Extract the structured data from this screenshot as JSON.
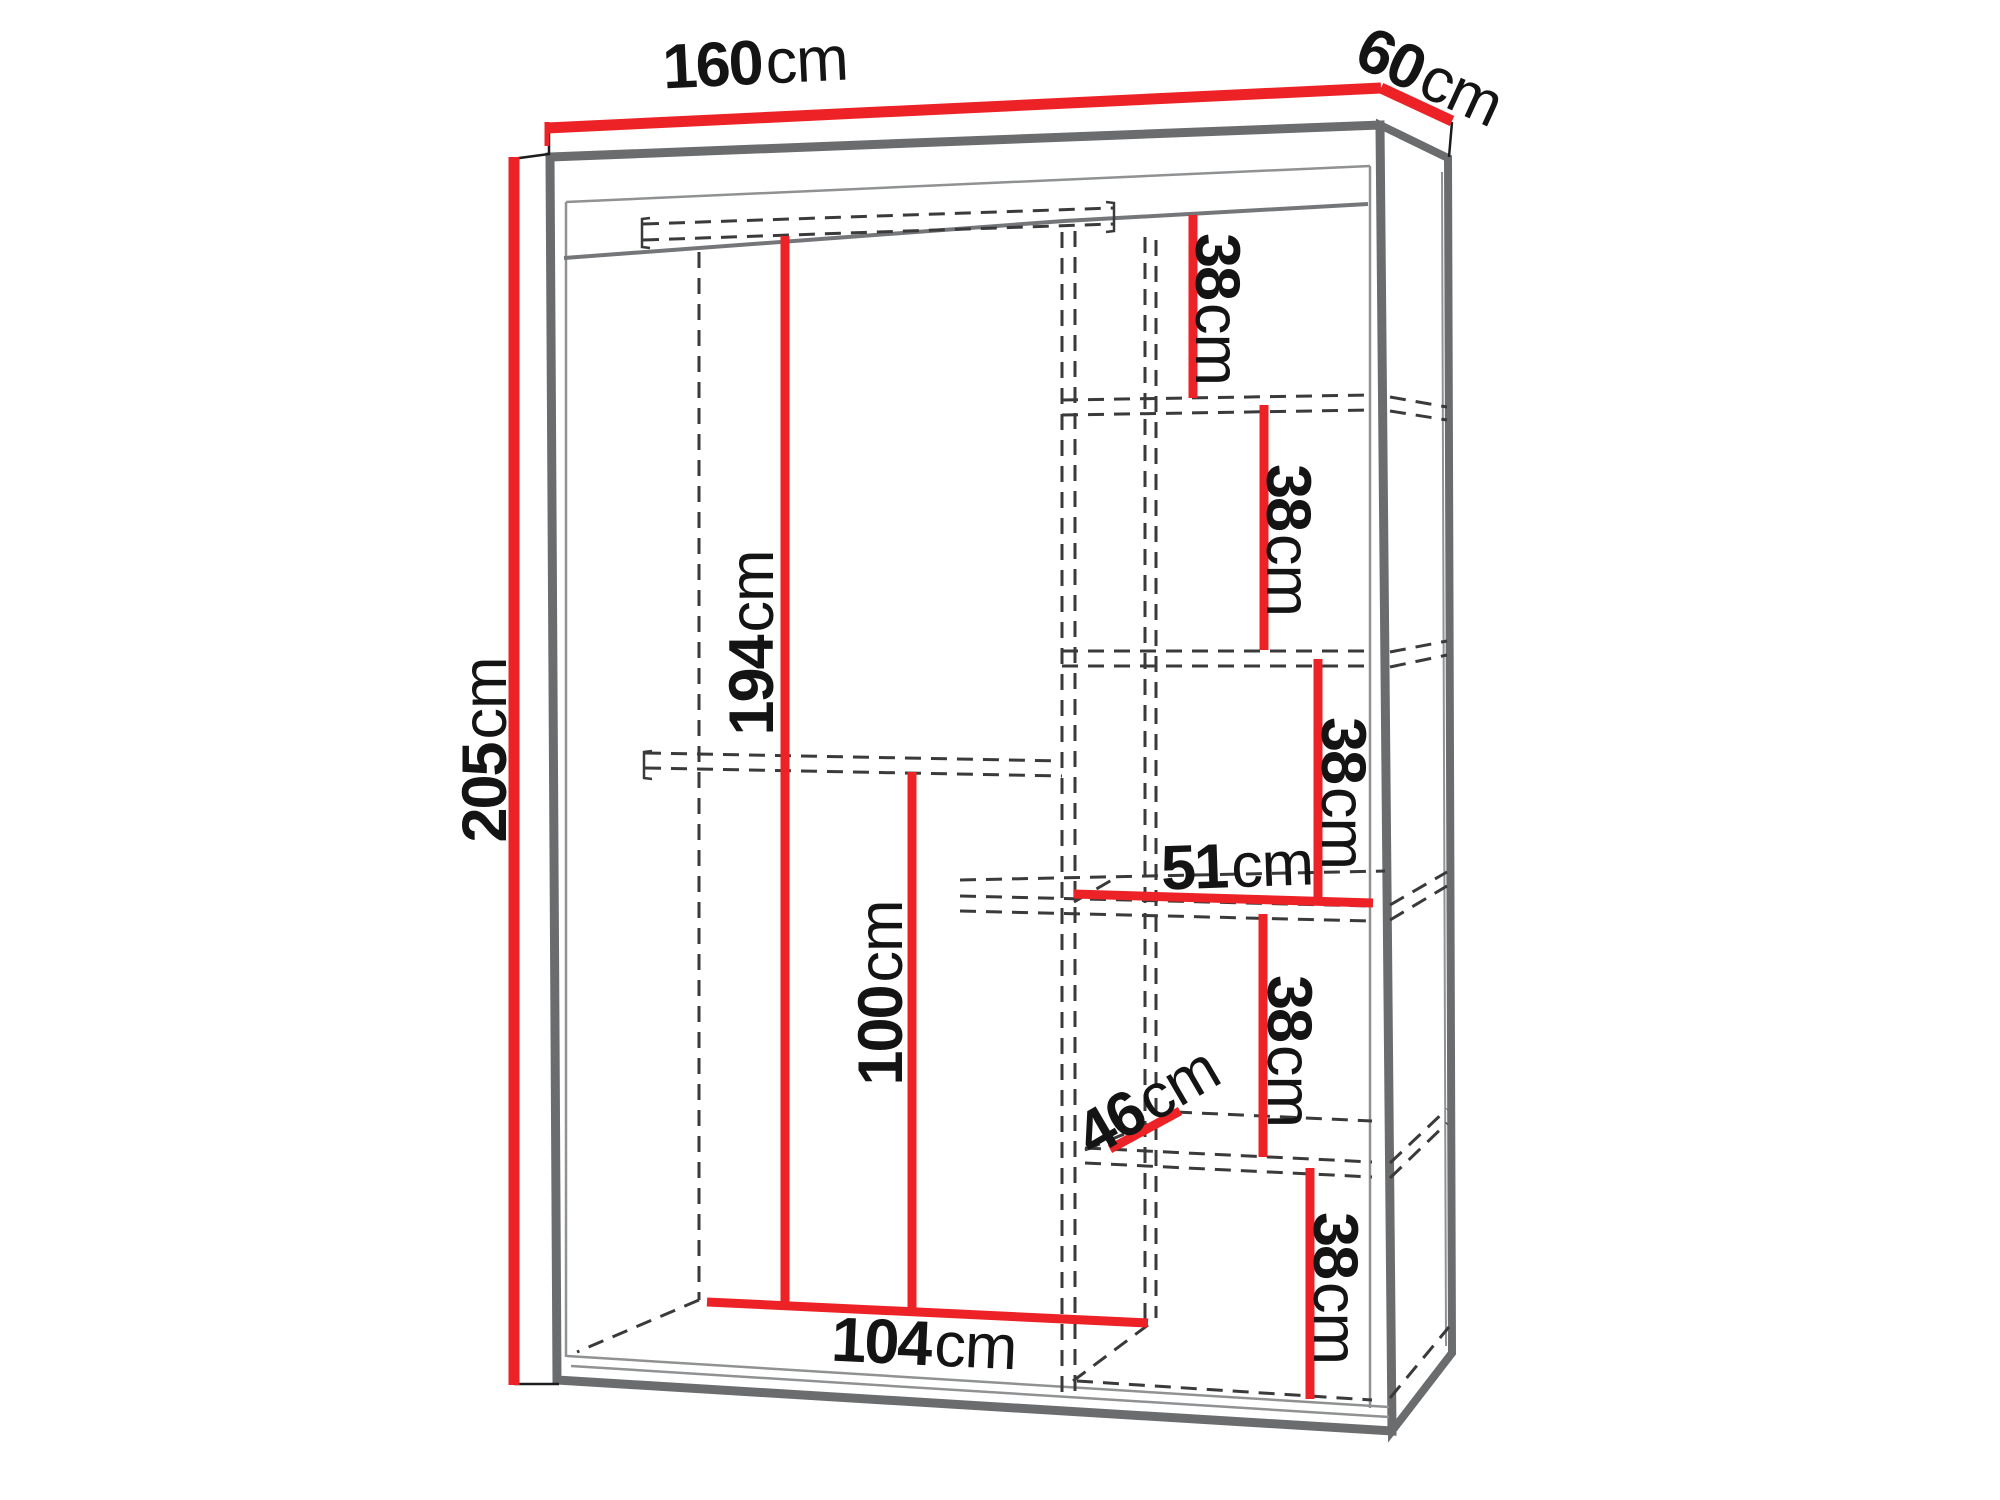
{
  "diagram": {
    "title": "Wardrobe dimension diagram",
    "subject": "wardrobe interior layout with shelves and hanging section",
    "unit": "cm",
    "colors": {
      "dimension": "#EC2227",
      "frame": "#6A6C6E",
      "frame_light": "#8F9193",
      "dashed": "#3A3A3A",
      "text": "#141414",
      "background": "#FFFFFF"
    },
    "dimensions": {
      "total_width": {
        "value": "160",
        "unit": "cm"
      },
      "total_depth": {
        "value": "60",
        "unit": "cm"
      },
      "total_height": {
        "value": "205",
        "unit": "cm"
      },
      "interior_height": {
        "value": "194",
        "unit": "cm"
      },
      "lower_section_height": {
        "value": "100",
        "unit": "cm"
      },
      "interior_width": {
        "value": "104",
        "unit": "cm"
      },
      "shelf_width": {
        "value": "51",
        "unit": "cm"
      },
      "shelf_depth": {
        "value": "46",
        "unit": "cm"
      },
      "shelf_spacing_1": {
        "value": "38",
        "unit": "cm"
      },
      "shelf_spacing_2": {
        "value": "38",
        "unit": "cm"
      },
      "shelf_spacing_3": {
        "value": "38",
        "unit": "cm"
      },
      "shelf_spacing_4": {
        "value": "38",
        "unit": "cm"
      },
      "shelf_spacing_5": {
        "value": "38",
        "unit": "cm"
      }
    }
  }
}
